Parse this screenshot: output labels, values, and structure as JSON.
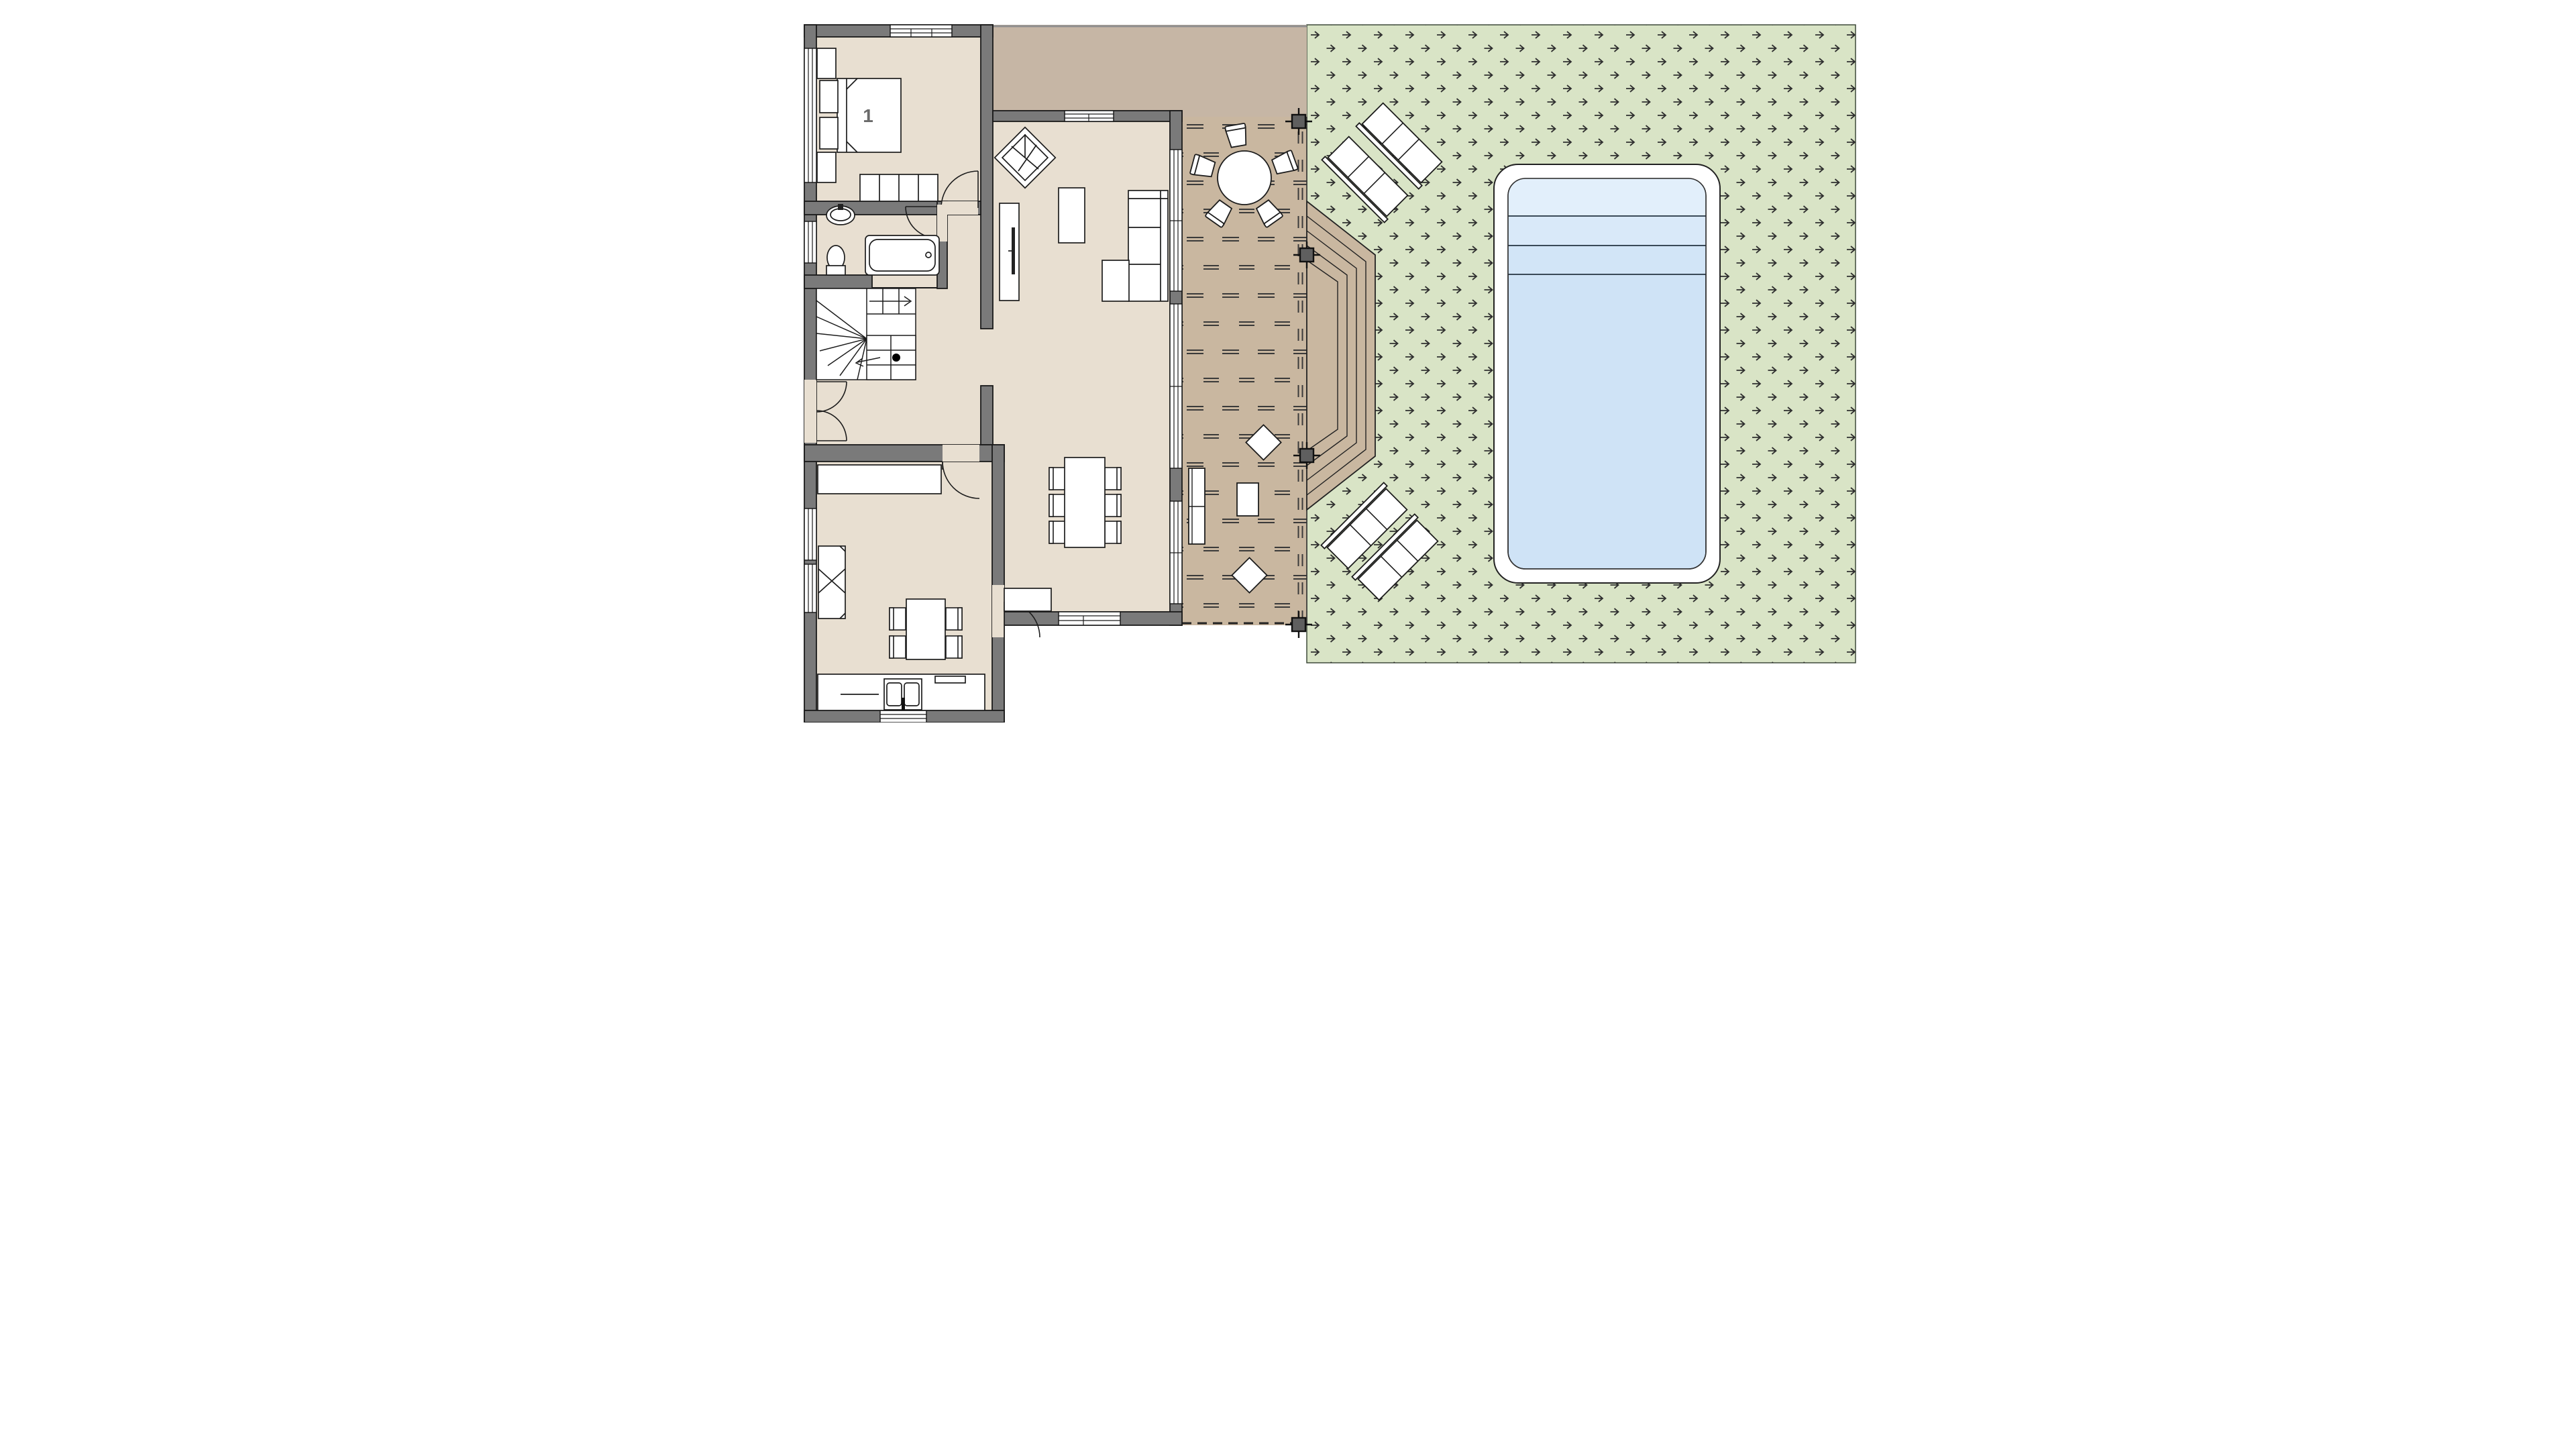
{
  "floor_plan": {
    "room_label": "1",
    "colors": {
      "wall": "#7a7a7a",
      "wall_outline": "#1a1a1a",
      "floor": "#e8dfd1",
      "driveway": "#c6b6a5",
      "deck": "#c9b7a0",
      "deck_dash": "#3a3a3a",
      "grass": "#d9e4c6",
      "grass_symbol": "#2f2f2f",
      "pool_coping": "#ffffff",
      "pool_water": "#cfe3f6",
      "pool_steps": "#e2effb",
      "furniture_fill": "#ffffff",
      "furniture_outline": "#1c1c1c",
      "post": "#5f5f5f"
    },
    "icons": {
      "grass_texture": "arrow-icon",
      "stair_direction": "arrow-right-icon"
    }
  }
}
